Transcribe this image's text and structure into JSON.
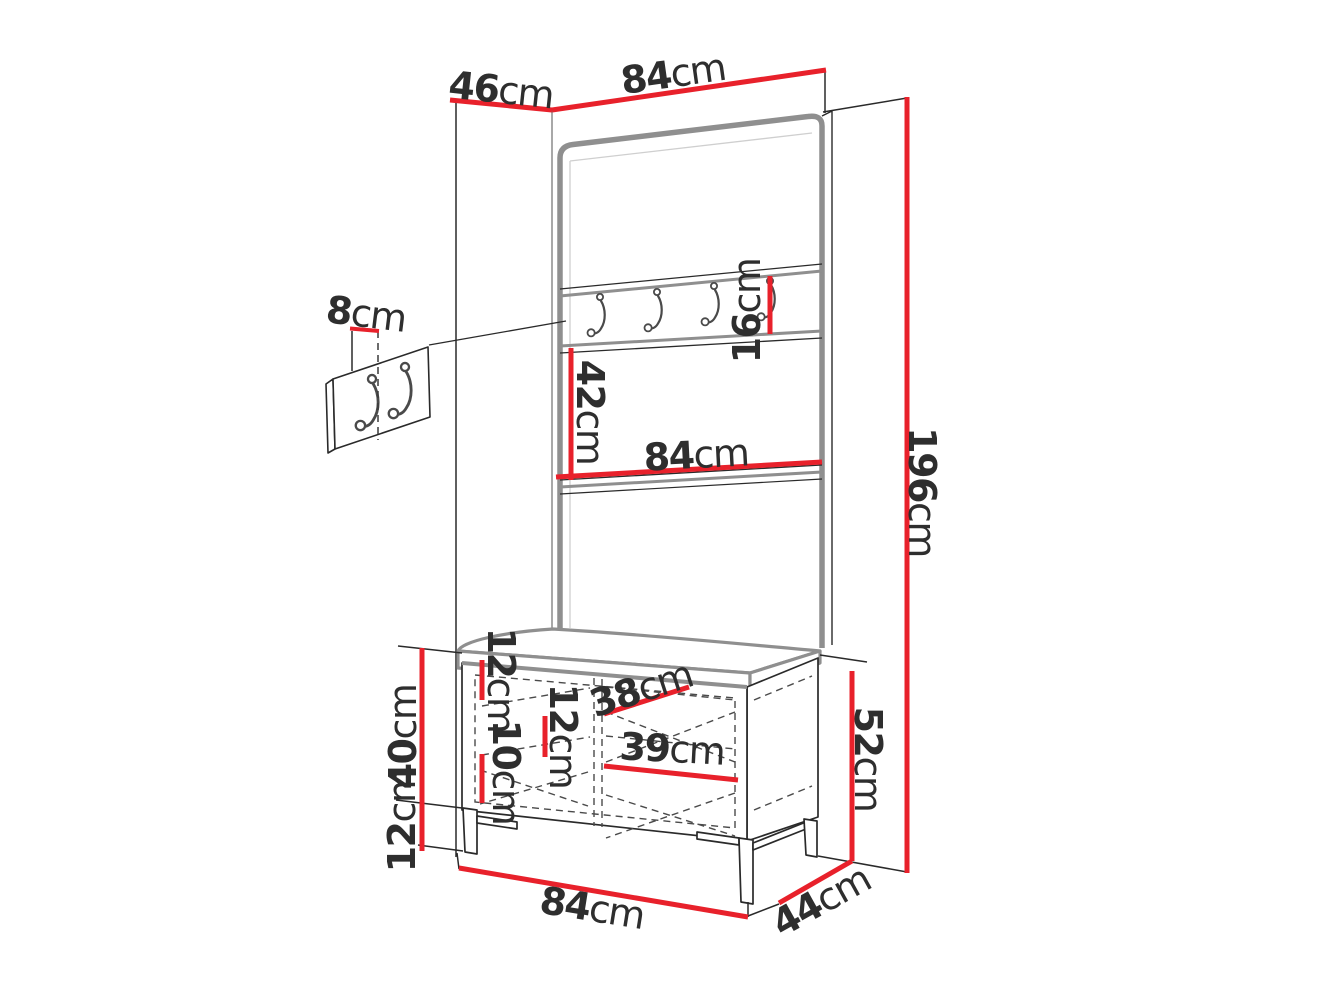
{
  "canvas": {
    "width": 1320,
    "height": 990,
    "background": "#ffffff"
  },
  "palette": {
    "dimension_red": "#e8212b",
    "line_black": "#2a2a2a",
    "edge_gray": "#8f8f8f",
    "text": "#2e2e2e"
  },
  "unit": "cm",
  "dims": {
    "d46": {
      "num": "46",
      "unit": "cm"
    },
    "d84_top": {
      "num": "84",
      "unit": "cm"
    },
    "d8": {
      "num": "8",
      "unit": "cm"
    },
    "d16": {
      "num": "16",
      "unit": "cm"
    },
    "d42": {
      "num": "42",
      "unit": "cm"
    },
    "d84_mid": {
      "num": "84",
      "unit": "cm"
    },
    "d196": {
      "num": "196",
      "unit": "cm"
    },
    "d12_top": {
      "num": "12",
      "unit": "cm"
    },
    "d12_mid": {
      "num": "12",
      "unit": "cm"
    },
    "d10": {
      "num": "10",
      "unit": "cm"
    },
    "d38": {
      "num": "38",
      "unit": "cm"
    },
    "d39": {
      "num": "39",
      "unit": "cm"
    },
    "d40": {
      "num": "40",
      "unit": "cm"
    },
    "d12_bottom": {
      "num": "12",
      "unit": "cm"
    },
    "d52": {
      "num": "52",
      "unit": "cm"
    },
    "d84_bottom": {
      "num": "84",
      "unit": "cm"
    },
    "d44": {
      "num": "44",
      "unit": "cm"
    }
  }
}
